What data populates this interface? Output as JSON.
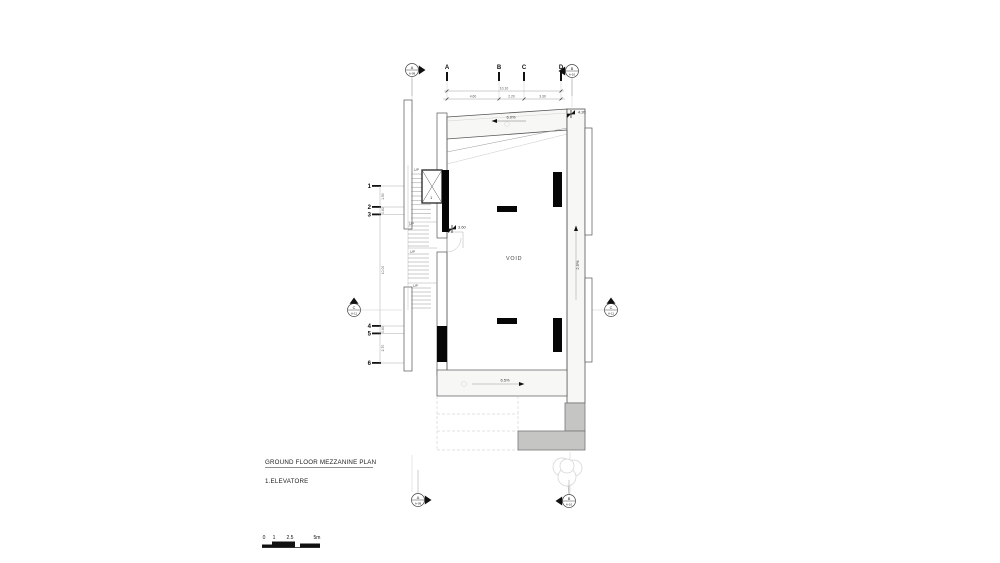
{
  "drawing": {
    "title": "GROUND FLOOR MEZZANINE PLAN",
    "legend": "1.ELEVATORE",
    "room_label": "VOID",
    "up_label": "UP",
    "elevator_number": "1"
  },
  "grid": {
    "columns": [
      "A",
      "B",
      "C",
      "D"
    ],
    "rows": [
      "1",
      "2",
      "3",
      "4",
      "5",
      "6"
    ]
  },
  "dimensions": {
    "top_total": "10.10",
    "top_segments": [
      "4.60",
      "2.20",
      "3.30"
    ],
    "left_segments": [
      "1.90",
      "0.60",
      "10.00",
      "0.60",
      "2.70"
    ]
  },
  "levels": {
    "top_right": "4.20",
    "elevator": "3.60"
  },
  "slopes": {
    "top": "6.0%",
    "bottom": "6.5%",
    "right": "2.5%"
  },
  "section_markers": [
    {
      "id": "top-left",
      "letter": "A",
      "sheet": "A-09"
    },
    {
      "id": "top-right",
      "letter": "B",
      "sheet": "A-10"
    },
    {
      "id": "mid-left",
      "letter": "C",
      "sheet": "A-11"
    },
    {
      "id": "mid-right",
      "letter": "C",
      "sheet": "A-11"
    },
    {
      "id": "bottom-left",
      "letter": "A",
      "sheet": "A-09"
    },
    {
      "id": "bottom-right",
      "letter": "B",
      "sheet": "A-10"
    }
  ],
  "scale_bar": {
    "labels": [
      "0",
      "1",
      "2.5",
      "5m"
    ]
  },
  "colors": {
    "line": "#444444",
    "poche": "#060606",
    "gray_fill": "#c5c5c3",
    "band_fill": "#f7f7f5"
  }
}
